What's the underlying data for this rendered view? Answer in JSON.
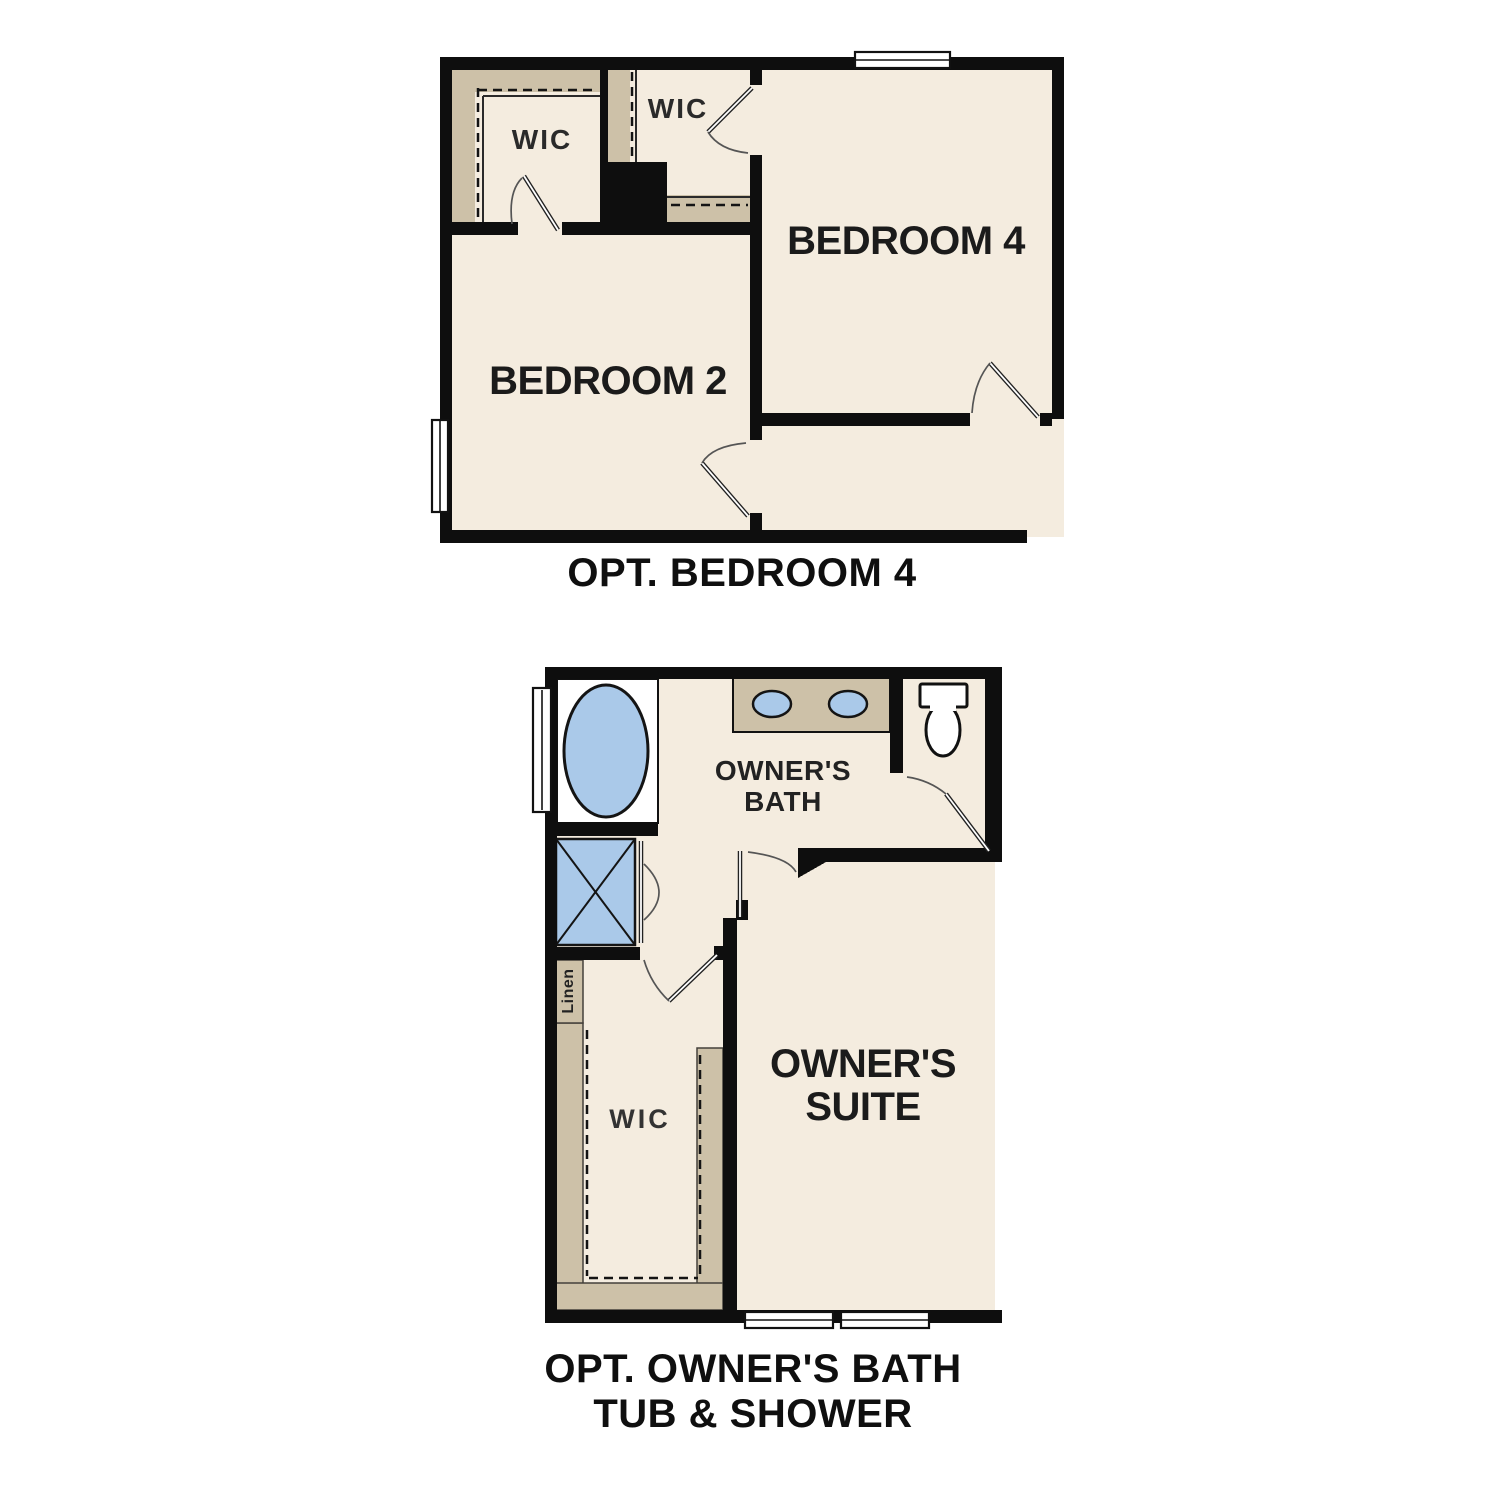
{
  "document": {
    "type": "floor-plan-options-sheet",
    "background": "#ffffff",
    "colors": {
      "wall": "#0e0e0e",
      "floor": "#f4ecdf",
      "shelving": "#cdc1a8",
      "fixture_blue": "#aac9e9",
      "label_text": "#1b1b1b"
    }
  },
  "plan_top": {
    "caption": "OPT. BEDROOM 4",
    "labels": {
      "wic_left": "WIC",
      "wic_middle": "WIC",
      "bedroom4": "BEDROOM 4",
      "bedroom2": "BEDROOM 2"
    }
  },
  "plan_bottom": {
    "caption_line1": "OPT. OWNER'S BATH",
    "caption_line2": "TUB & SHOWER",
    "labels": {
      "bath_line1": "OWNER'S",
      "bath_line2": "BATH",
      "suite_line1": "OWNER'S",
      "suite_line2": "SUITE",
      "wic": "WIC",
      "linen": "Linen"
    }
  }
}
